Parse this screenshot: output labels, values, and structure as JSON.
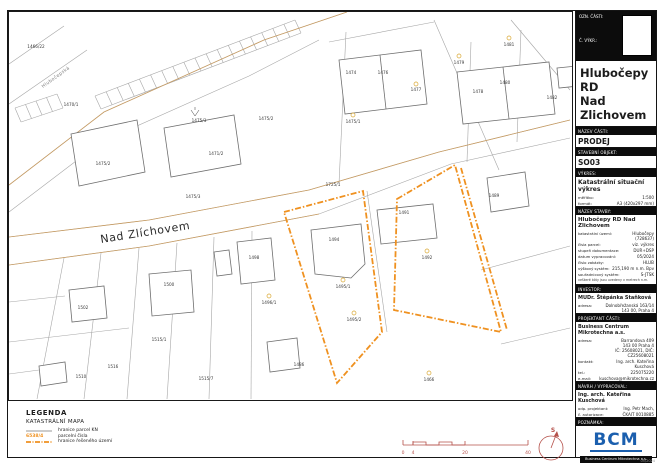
{
  "title_block": {
    "header": {
      "part_label": "OZN. ČÁSTI:",
      "drawing_no_label": "Č. VÝKR.:"
    },
    "project_title": "Hlubočepy RD\nNad\nZlichovem",
    "sections": {
      "nazev_casti": {
        "label": "NÁZEV ČÁSTI:",
        "value": "PRODEJ"
      },
      "stavebni_objekt": {
        "label": "STAVEBNÍ OBJEKT:",
        "value": "SO03"
      },
      "vykres": {
        "label": "VÝKRES:",
        "value": "Katastrální situační výkres",
        "rows": [
          {
            "label": "měřítko:",
            "value": "1:500"
          },
          {
            "label": "formát:",
            "value": "A3 (420x297 mm)"
          }
        ]
      },
      "nazev_stavby": {
        "label": "NÁZEV STAVBY:",
        "value": "Hlubočepy RD Nad Zlichovem",
        "rows": [
          {
            "label": "katastrální území:",
            "value": "Hlubočepy (728637)"
          },
          {
            "label": "čísla parcel:",
            "value": "viz. výkres"
          },
          {
            "label": "stupeň dokumentace:",
            "value": "DUR+DSP"
          },
          {
            "label": "datum vypracování:",
            "value": "05/2024"
          },
          {
            "label": "číslo zakázky:",
            "value": "HLUB"
          },
          {
            "label": "výškový systém:",
            "value": "215,190 m n.m. Bpv"
          },
          {
            "label": "souřadnicový systém:",
            "value": "S-JTSK"
          }
        ],
        "note": "veškeré kóty jsou uvedeny v metrech n.m."
      },
      "investor": {
        "label": "INVESTOR:",
        "value": "MUDr. Štěpánka Staňková",
        "rows": [
          {
            "label": "adresa:",
            "value": "Dolnobřežanská 163/14\n143 00, Praha 4"
          }
        ]
      },
      "projektant": {
        "label": "PROJEKTANT ČÁSTI:",
        "value": "Business Centrum Mikrotechna a.s.",
        "rows": [
          {
            "label": "adresa:",
            "value": "Barrandova 409\n143 00 Praha 4\nIČ: 25608021, DIČ: CZ25608021"
          },
          {
            "label": "kontakt:",
            "value": "Ing. arch. Kateřina Kuschová"
          },
          {
            "label": "tel.:",
            "value": "225075220"
          },
          {
            "label": "e-mail:",
            "value": "kuschova@mikrotechna.cz"
          }
        ]
      },
      "navrh": {
        "label": "NÁVRH / VYPRACOVAL:",
        "value": "Ing. arch. Kateřina Kuschová",
        "rows": [
          {
            "label": "odp. projektant:",
            "value": "Ing. Petr Mach,"
          },
          {
            "label": "č. autorizace:",
            "value": "ČKAIT 0010885"
          }
        ]
      },
      "poznamka": {
        "label": "POZNÁMKA:",
        "value": ""
      }
    },
    "logo": {
      "text": "BCM",
      "caption": "Business Centrum Mikrotechna a.s.",
      "footnote": "05/2024"
    }
  },
  "legend": {
    "title": "LEGENDA",
    "subtitle": "KATASTRÁLNÍ MAPA",
    "rows": [
      {
        "symbol": "gray-line",
        "label": "hranice parcel KN"
      },
      {
        "symbol": "orange-number",
        "symbol_text": "6538/4",
        "label": "parcelní čísla"
      },
      {
        "symbol": "orange-dashdot",
        "label": "hranice řešeného území"
      }
    ]
  },
  "map": {
    "street_label": "Nad Zlíchovem",
    "road_label": "Hlubočepská",
    "colors": {
      "boundary": "#ef9120",
      "road_edge": "#c79c63",
      "parcel_line": "#a6a6a6"
    },
    "labels": [
      {
        "t": "1466/22",
        "x": 27,
        "y": 36
      },
      {
        "t": "1470/1",
        "x": 62,
        "y": 94
      },
      {
        "t": "1475/3",
        "x": 190,
        "y": 110
      },
      {
        "t": "1475/2",
        "x": 257,
        "y": 108
      },
      {
        "t": "1471/2",
        "x": 207,
        "y": 143
      },
      {
        "t": "1475/2",
        "x": 94,
        "y": 153
      },
      {
        "t": "1475/3",
        "x": 184,
        "y": 186
      },
      {
        "t": "1474",
        "x": 342,
        "y": 62
      },
      {
        "t": "1476",
        "x": 374,
        "y": 62
      },
      {
        "t": "1477",
        "x": 407,
        "y": 79
      },
      {
        "t": "1479",
        "x": 450,
        "y": 52
      },
      {
        "t": "1481",
        "x": 500,
        "y": 34
      },
      {
        "t": "1478",
        "x": 469,
        "y": 81
      },
      {
        "t": "1480",
        "x": 496,
        "y": 72
      },
      {
        "t": "1482",
        "x": 543,
        "y": 87
      },
      {
        "t": "1475/1",
        "x": 344,
        "y": 111
      },
      {
        "t": "1489",
        "x": 485,
        "y": 185
      },
      {
        "t": "1725/1",
        "x": 324,
        "y": 174
      },
      {
        "t": "1494",
        "x": 325,
        "y": 229
      },
      {
        "t": "1491",
        "x": 395,
        "y": 202
      },
      {
        "t": "1492",
        "x": 418,
        "y": 247
      },
      {
        "t": "1495/1",
        "x": 334,
        "y": 276
      },
      {
        "t": "1495/2",
        "x": 345,
        "y": 309
      },
      {
        "t": "1502",
        "x": 74,
        "y": 297
      },
      {
        "t": "1500",
        "x": 160,
        "y": 274
      },
      {
        "t": "1498",
        "x": 245,
        "y": 247
      },
      {
        "t": "1496/1",
        "x": 260,
        "y": 292
      },
      {
        "t": "1486",
        "x": 290,
        "y": 354
      },
      {
        "t": "1466",
        "x": 420,
        "y": 369
      },
      {
        "t": "1515/1",
        "x": 150,
        "y": 329
      },
      {
        "t": "1516",
        "x": 104,
        "y": 356
      },
      {
        "t": "1510",
        "x": 72,
        "y": 366
      },
      {
        "t": "1515/7",
        "x": 197,
        "y": 368
      }
    ],
    "rings": [
      {
        "x": 407,
        "y": 72
      },
      {
        "x": 450,
        "y": 44
      },
      {
        "x": 500,
        "y": 26
      },
      {
        "x": 344,
        "y": 103
      },
      {
        "x": 418,
        "y": 239
      },
      {
        "x": 334,
        "y": 268
      },
      {
        "x": 345,
        "y": 301
      },
      {
        "x": 260,
        "y": 284
      },
      {
        "x": 420,
        "y": 361
      }
    ]
  },
  "scalebar": {
    "ticks": [
      "0",
      "4",
      "20",
      "40"
    ]
  },
  "north": {
    "label": "S"
  }
}
